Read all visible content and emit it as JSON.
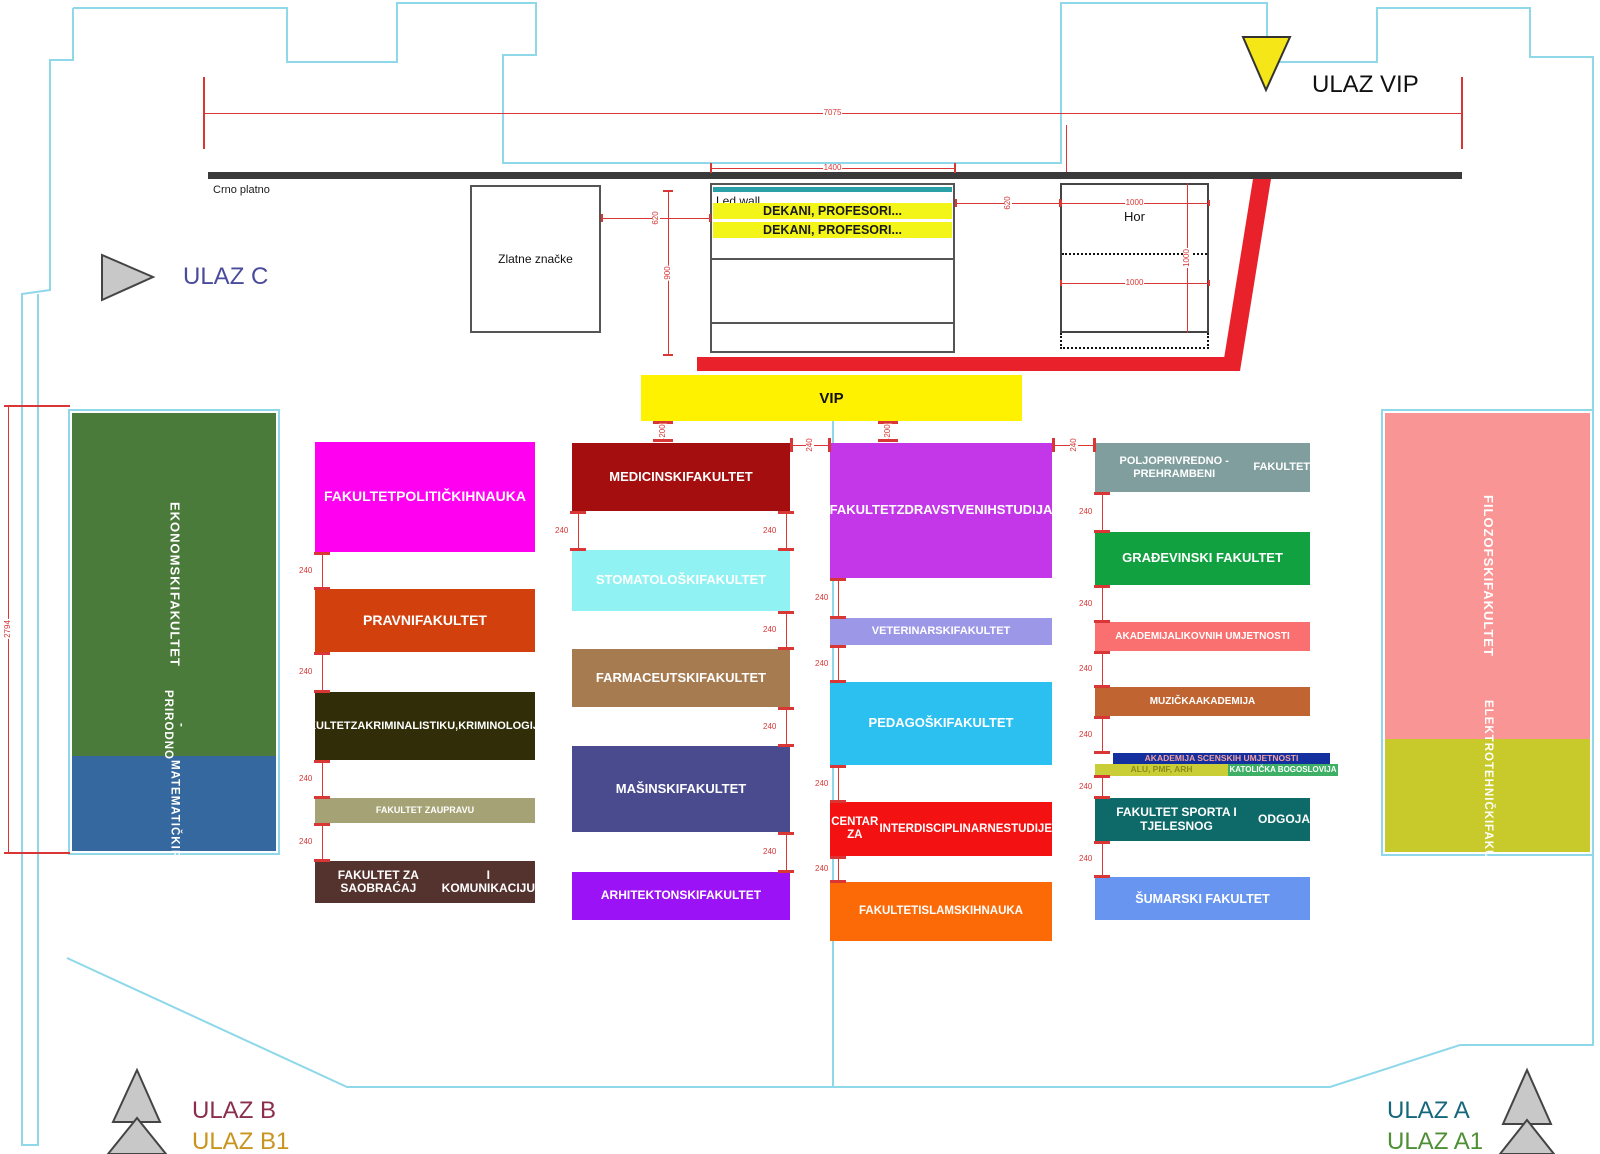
{
  "palette": {
    "outline_cyan": "#8ed8ea",
    "dim_red": "#d93636",
    "carpet_red": "#e8212b",
    "stage_bar_dark": "#3a3a3a",
    "vip_yellow": "#fff200",
    "row_yellow": "#f3f518",
    "triangle_gray": "#c8c8c8",
    "vip_triangle_yellow": "#f5e617"
  },
  "entrances": {
    "vip": {
      "label": "ULAZ VIP",
      "color": "#111111"
    },
    "c": {
      "label": "ULAZ C",
      "color": "#4b4b9b"
    },
    "b": {
      "label": "ULAZ B",
      "color": "#8b2e4e"
    },
    "b1": {
      "label": "ULAZ B1",
      "color": "#c8941e"
    },
    "a": {
      "label": "ULAZ A",
      "color": "#17677c"
    },
    "a1": {
      "label": "ULAZ A1",
      "color": "#4f8f35"
    }
  },
  "stage": {
    "crno_platno": "Crno platno",
    "led_wall": "Led wall",
    "rows": [
      "DEKANI, PROFESORI...",
      "DEKANI, PROFESORI..."
    ],
    "zlatne": "Zlatne značke",
    "hor": "Hor",
    "vip": "VIP"
  },
  "faculty_blocks": [
    {
      "id": "ekonomski",
      "x": 72,
      "y": 413,
      "w": 204,
      "h": 343,
      "bg": "#4b7b3b",
      "fg": "#ffffff",
      "fs": 13,
      "vertical": true,
      "lines": [
        "EKONOMSKI",
        "FAKULTET"
      ]
    },
    {
      "id": "prirodno-matematicki",
      "x": 72,
      "y": 756,
      "w": 204,
      "h": 95,
      "bg": "#34689f",
      "fg": "#ffffff",
      "fs": 11.5,
      "vertical": true,
      "lines": [
        "PRIRODNO -",
        "MATEMATIČKI",
        "FAKULTET"
      ]
    },
    {
      "id": "filozofski",
      "x": 1385,
      "y": 413,
      "w": 205,
      "h": 326,
      "bg": "#fa9595",
      "fg": "#ffffff",
      "fs": 13,
      "vertical": true,
      "lines": [
        "FILOZOFSKI",
        "FAKULTET"
      ]
    },
    {
      "id": "elektrotehnicki",
      "x": 1385,
      "y": 739,
      "w": 205,
      "h": 113,
      "bg": "#c7ca2a",
      "fg": "#ffffff",
      "fs": 11.5,
      "vertical": true,
      "lines": [
        "ELEKTROTEHNIČKI",
        "FAKULTET"
      ]
    },
    {
      "id": "politickih-nauka",
      "x": 315,
      "y": 442,
      "w": 220,
      "h": 110,
      "bg": "#ff00f0",
      "fg": "#ffffff",
      "fs": 14,
      "lines": [
        "FAKULTET",
        "POLITIČKIH",
        "NAUKA"
      ]
    },
    {
      "id": "pravni",
      "x": 315,
      "y": 589,
      "w": 220,
      "h": 63,
      "bg": "#d2400e",
      "fg": "#ffffff",
      "fs": 14,
      "lines": [
        "PRAVNI",
        "FAKULTET"
      ]
    },
    {
      "id": "kriminalistika",
      "x": 315,
      "y": 692,
      "w": 220,
      "h": 68,
      "bg": "#302d08",
      "fg": "#ffffff",
      "fs": 11,
      "lines": [
        "FAKULTET",
        "ZA",
        "KRIMINALISTIKU,",
        "KRIMINOLOGIJU..."
      ]
    },
    {
      "id": "uprava",
      "x": 315,
      "y": 798,
      "w": 220,
      "h": 25,
      "bg": "#a5a376",
      "fg": "#ffffff",
      "fs": 9,
      "lines": [
        "FAKULTET ZA",
        "UPRAVU"
      ]
    },
    {
      "id": "saobracaj",
      "x": 315,
      "y": 861,
      "w": 220,
      "h": 42,
      "bg": "#54322e",
      "fg": "#ffffff",
      "fs": 12,
      "lines": [
        "FAKULTET ZA SAOBRAĆAJ",
        "I KOMUNIKACIJU"
      ]
    },
    {
      "id": "medicinski",
      "x": 572,
      "y": 443,
      "w": 218,
      "h": 68,
      "bg": "#a40e0e",
      "fg": "#ffffff",
      "fs": 13,
      "lines": [
        "MEDICINSKI",
        "FAKULTET"
      ]
    },
    {
      "id": "stomatoloski",
      "x": 572,
      "y": 550,
      "w": 218,
      "h": 61,
      "bg": "#90f2f2",
      "fg": "#ffffff",
      "fs": 13,
      "lines": [
        "STOMATOLOŠKI",
        "FAKULTET"
      ]
    },
    {
      "id": "farmaceutski",
      "x": 572,
      "y": 649,
      "w": 218,
      "h": 58,
      "bg": "#a77b50",
      "fg": "#ffffff",
      "fs": 13,
      "lines": [
        "FARMACEUTSKI",
        "FAKULTET"
      ]
    },
    {
      "id": "masinski",
      "x": 572,
      "y": 746,
      "w": 218,
      "h": 86,
      "bg": "#4a4a8f",
      "fg": "#ffffff",
      "fs": 13,
      "lines": [
        "MAŠINSKI",
        "FAKULTET"
      ]
    },
    {
      "id": "arhitektonski",
      "x": 572,
      "y": 872,
      "w": 218,
      "h": 48,
      "bg": "#9a12f5",
      "fg": "#ffffff",
      "fs": 12,
      "lines": [
        "ARHITEKTONSKI",
        "FAKULTET"
      ]
    },
    {
      "id": "zdravstvenih",
      "x": 830,
      "y": 443,
      "w": 222,
      "h": 135,
      "bg": "#c437e9",
      "fg": "#ffffff",
      "fs": 13,
      "lines": [
        "FAKULTET",
        "ZDRAVSTVENIH",
        "STUDIJA"
      ]
    },
    {
      "id": "veterinarski",
      "x": 830,
      "y": 618,
      "w": 222,
      "h": 27,
      "bg": "#9c97e6",
      "fg": "#ffffff",
      "fs": 11,
      "lines": [
        "VETERINARSKI",
        "FAKULTET"
      ]
    },
    {
      "id": "pedagoski",
      "x": 830,
      "y": 682,
      "w": 222,
      "h": 83,
      "bg": "#2bc0f0",
      "fg": "#ffffff",
      "fs": 13,
      "lines": [
        "PEDAGOŠKI",
        "FAKULTET"
      ]
    },
    {
      "id": "centar-interdisciplinarne",
      "x": 830,
      "y": 802,
      "w": 222,
      "h": 54,
      "bg": "#f41111",
      "fg": "#ffffff",
      "fs": 11.5,
      "lines": [
        "CENTAR ZA",
        "INTERDISCIPLINARNE",
        "STUDIJE"
      ]
    },
    {
      "id": "islamskih",
      "x": 830,
      "y": 882,
      "w": 222,
      "h": 59,
      "bg": "#fc6a07",
      "fg": "#ffffff",
      "fs": 11.5,
      "lines": [
        "FAKULTET",
        "ISLAMSKIH",
        "NAUKA"
      ]
    },
    {
      "id": "poljoprivredno",
      "x": 1095,
      "y": 443,
      "w": 215,
      "h": 49,
      "bg": "#7f9e9d",
      "fg": "#ffffff",
      "fs": 11,
      "lines": [
        "POLJOPRIVREDNO - PREHRAMBENI",
        "FAKULTET"
      ]
    },
    {
      "id": "gradjevinski",
      "x": 1095,
      "y": 532,
      "w": 215,
      "h": 53,
      "bg": "#12a140",
      "fg": "#ffffff",
      "fs": 13,
      "lines": [
        "GRAĐEVINSKI FAKULTET"
      ]
    },
    {
      "id": "likovnih",
      "x": 1095,
      "y": 622,
      "w": 215,
      "h": 29,
      "bg": "#fa6f6f",
      "fg": "#ffffff",
      "fs": 10,
      "lines": [
        "AKADEMIJA",
        "LIKOVNIH UMJETNOSTI"
      ]
    },
    {
      "id": "muzicka",
      "x": 1095,
      "y": 687,
      "w": 215,
      "h": 29,
      "bg": "#c06431",
      "fg": "#ffffff",
      "fs": 10,
      "lines": [
        "MUZIČKA",
        "AKADEMIJA"
      ]
    },
    {
      "id": "scenskih",
      "x": 1113,
      "y": 753,
      "w": 217,
      "h": 11,
      "bg": "#142f9e",
      "fg": "#f2a0a0",
      "fs": 8.5,
      "lines": [
        "AKADEMIJA SCENSKIH UMJETNOSTI"
      ]
    },
    {
      "id": "alu-pmf-arh",
      "x": 1095,
      "y": 764,
      "w": 133,
      "h": 12,
      "bg": "#c9cd36",
      "fg": "#8c8c1c",
      "fs": 8.5,
      "lines": [
        "ALU, PMF, ARH"
      ]
    },
    {
      "id": "katolicka-bogoslovija",
      "x": 1228,
      "y": 764,
      "w": 110,
      "h": 12,
      "bg": "#3eb066",
      "fg": "#ffffff",
      "fs": 8,
      "lines": [
        "KATOLIČKA BOGOSLOVIJA"
      ]
    },
    {
      "id": "sporta",
      "x": 1095,
      "y": 798,
      "w": 215,
      "h": 43,
      "bg": "#0e6969",
      "fg": "#ffffff",
      "fs": 12,
      "lines": [
        "FAKULTET SPORTA I TJELESNOG",
        "ODGOJA"
      ]
    },
    {
      "id": "sumarski",
      "x": 1095,
      "y": 877,
      "w": 215,
      "h": 43,
      "bg": "#6895ef",
      "fg": "#ffffff",
      "fs": 12.5,
      "lines": [
        "ŠUMARSKI FAKULTET"
      ]
    }
  ],
  "gap_markers": {
    "label": "240",
    "vertical": [
      {
        "x": 322,
        "y1": 552,
        "y2": 589
      },
      {
        "x": 322,
        "y1": 652,
        "y2": 692
      },
      {
        "x": 322,
        "y1": 760,
        "y2": 798
      },
      {
        "x": 322,
        "y1": 823,
        "y2": 861
      },
      {
        "x": 578,
        "y1": 511,
        "y2": 550
      },
      {
        "x": 786,
        "y1": 511,
        "y2": 550
      },
      {
        "x": 786,
        "y1": 611,
        "y2": 649
      },
      {
        "x": 786,
        "y1": 707,
        "y2": 746
      },
      {
        "x": 786,
        "y1": 832,
        "y2": 872
      },
      {
        "x": 838,
        "y1": 578,
        "y2": 618
      },
      {
        "x": 838,
        "y1": 645,
        "y2": 682
      },
      {
        "x": 838,
        "y1": 765,
        "y2": 802
      },
      {
        "x": 838,
        "y1": 856,
        "y2": 882
      },
      {
        "x": 1102,
        "y1": 492,
        "y2": 532
      },
      {
        "x": 1102,
        "y1": 585,
        "y2": 622
      },
      {
        "x": 1102,
        "y1": 651,
        "y2": 687
      },
      {
        "x": 1102,
        "y1": 716,
        "y2": 753
      },
      {
        "x": 1102,
        "y1": 775,
        "y2": 798
      },
      {
        "x": 1102,
        "y1": 841,
        "y2": 877
      }
    ],
    "horizontal": [
      {
        "y": 445,
        "x1": 790,
        "x2": 830
      },
      {
        "y": 445,
        "x1": 1052,
        "x2": 1095
      }
    ],
    "vip_gap_label": "200",
    "vip_gaps": [
      {
        "x": 663,
        "y1": 421,
        "y2": 441
      },
      {
        "x": 888,
        "y1": 421,
        "y2": 441
      }
    ]
  },
  "dim_lines": [
    {
      "id": "width-7075",
      "label": "7075",
      "type": "h",
      "x1": 203,
      "x2": 1462,
      "y": 113,
      "endticks": 36
    },
    {
      "id": "stage-width-1400",
      "label": "1400",
      "type": "h",
      "x1": 710,
      "x2": 955,
      "y": 168,
      "endticks": 5
    },
    {
      "id": "gap-620-left",
      "label": "620",
      "type": "h",
      "x1": 601,
      "x2": 710,
      "y": 218,
      "rot": true,
      "endticks": 4
    },
    {
      "id": "stage-height-900",
      "label": "900",
      "type": "v",
      "x": 668,
      "y1": 190,
      "y2": 355,
      "rot": true,
      "endticks": 5
    },
    {
      "id": "gap-620-right",
      "label": "620",
      "type": "h",
      "x1": 955,
      "x2": 1060,
      "y": 203,
      "rot": true,
      "endticks": 4
    },
    {
      "id": "hor-1000-top",
      "label": "1000",
      "type": "h",
      "x1": 1060,
      "x2": 1209,
      "y": 203,
      "endticks": 3
    },
    {
      "id": "hor-1000-vert",
      "label": "1000",
      "type": "v",
      "x": 1187,
      "y1": 183,
      "y2": 333,
      "rot": true,
      "endticks": 0
    },
    {
      "id": "hor-1000-mid",
      "label": "1000",
      "type": "h",
      "x1": 1060,
      "x2": 1209,
      "y": 283,
      "endticks": 3
    },
    {
      "id": "left-height-2794",
      "label": "2794",
      "type": "v",
      "x": 8,
      "y1": 405,
      "y2": 852,
      "endticks": 0,
      "caps": [
        {
          "y": 405,
          "x1": 4,
          "x2": 70
        },
        {
          "y": 852,
          "x1": 4,
          "x2": 70
        }
      ]
    },
    {
      "id": "tick-1066",
      "label": "",
      "type": "v",
      "x": 1066,
      "y1": 125,
      "y2": 172,
      "endticks": 0
    }
  ]
}
